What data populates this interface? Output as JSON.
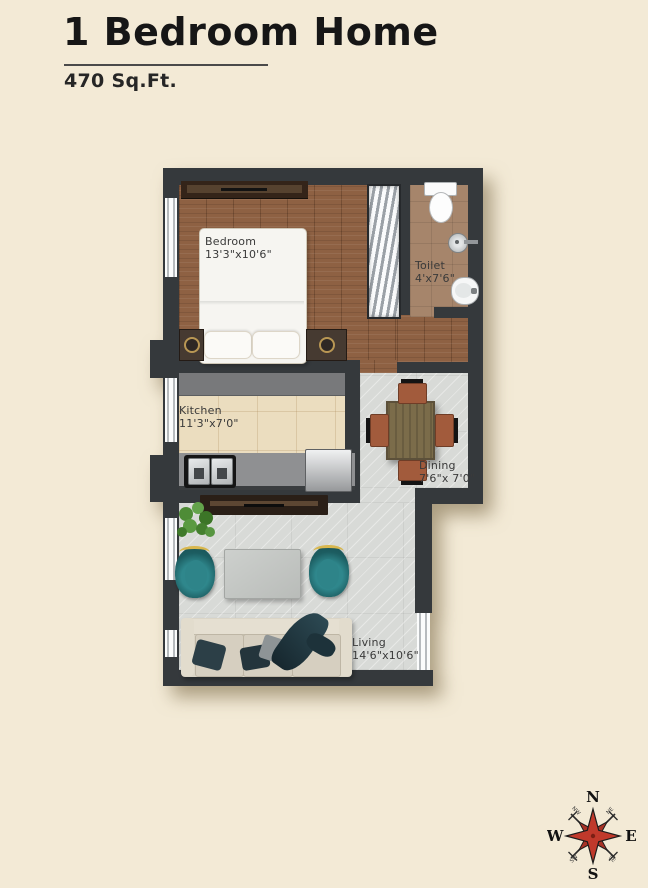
{
  "header": {
    "title": "1 Bedroom Home",
    "area": "470 Sq.Ft."
  },
  "rooms": {
    "bedroom": {
      "name": "Bedroom",
      "dims": "13'3\"x10'6\""
    },
    "toilet": {
      "name": "Toilet",
      "dims": "4'x7'6\""
    },
    "kitchen": {
      "name": "Kitchen",
      "dims": "11'3\"x7'0\""
    },
    "dining": {
      "name": "Dining",
      "dims": "7'6\"x 7'0\""
    },
    "living": {
      "name": "Living",
      "dims": "14'6\"x10'6\""
    }
  },
  "compass": {
    "north": "N",
    "south": "S",
    "east": "E",
    "west": "W",
    "northwest": "NW",
    "northeast": "NE",
    "southwest": "SW",
    "southeast": "SE"
  },
  "colors": {
    "background": "#f3ead6",
    "wall": "#35393c",
    "wood_floor": "#8e6143",
    "marble_floor": "#d8dad7",
    "kitchen_floor": "#ebddbf",
    "toilet_floor": "#a6856b",
    "compass_red": "#c0392b",
    "armchair_teal": "#2f878c",
    "title_text": "#161616"
  }
}
